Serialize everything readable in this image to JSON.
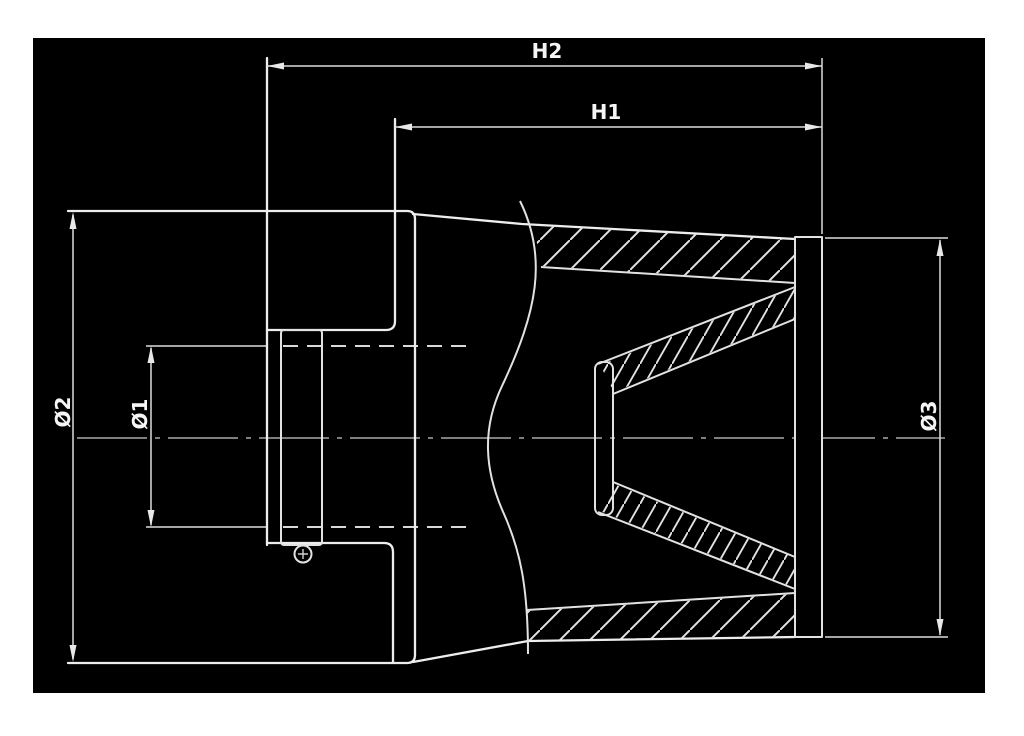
{
  "drawing": {
    "type": "technical-section-drawing",
    "subject": "cone-air-filter-cross-section",
    "page_background": "#ffffff",
    "canvas_background": "#000000",
    "line_color": "#ededed",
    "dimension_line_color": "#dcdcdc",
    "centerline_color": "#a8a8a8",
    "text_color": "#f5f5f5",
    "labels": {
      "h2": "H2",
      "h1": "H1",
      "dia1": "Ø1",
      "dia2": "Ø2",
      "dia3": "Ø3"
    }
  }
}
